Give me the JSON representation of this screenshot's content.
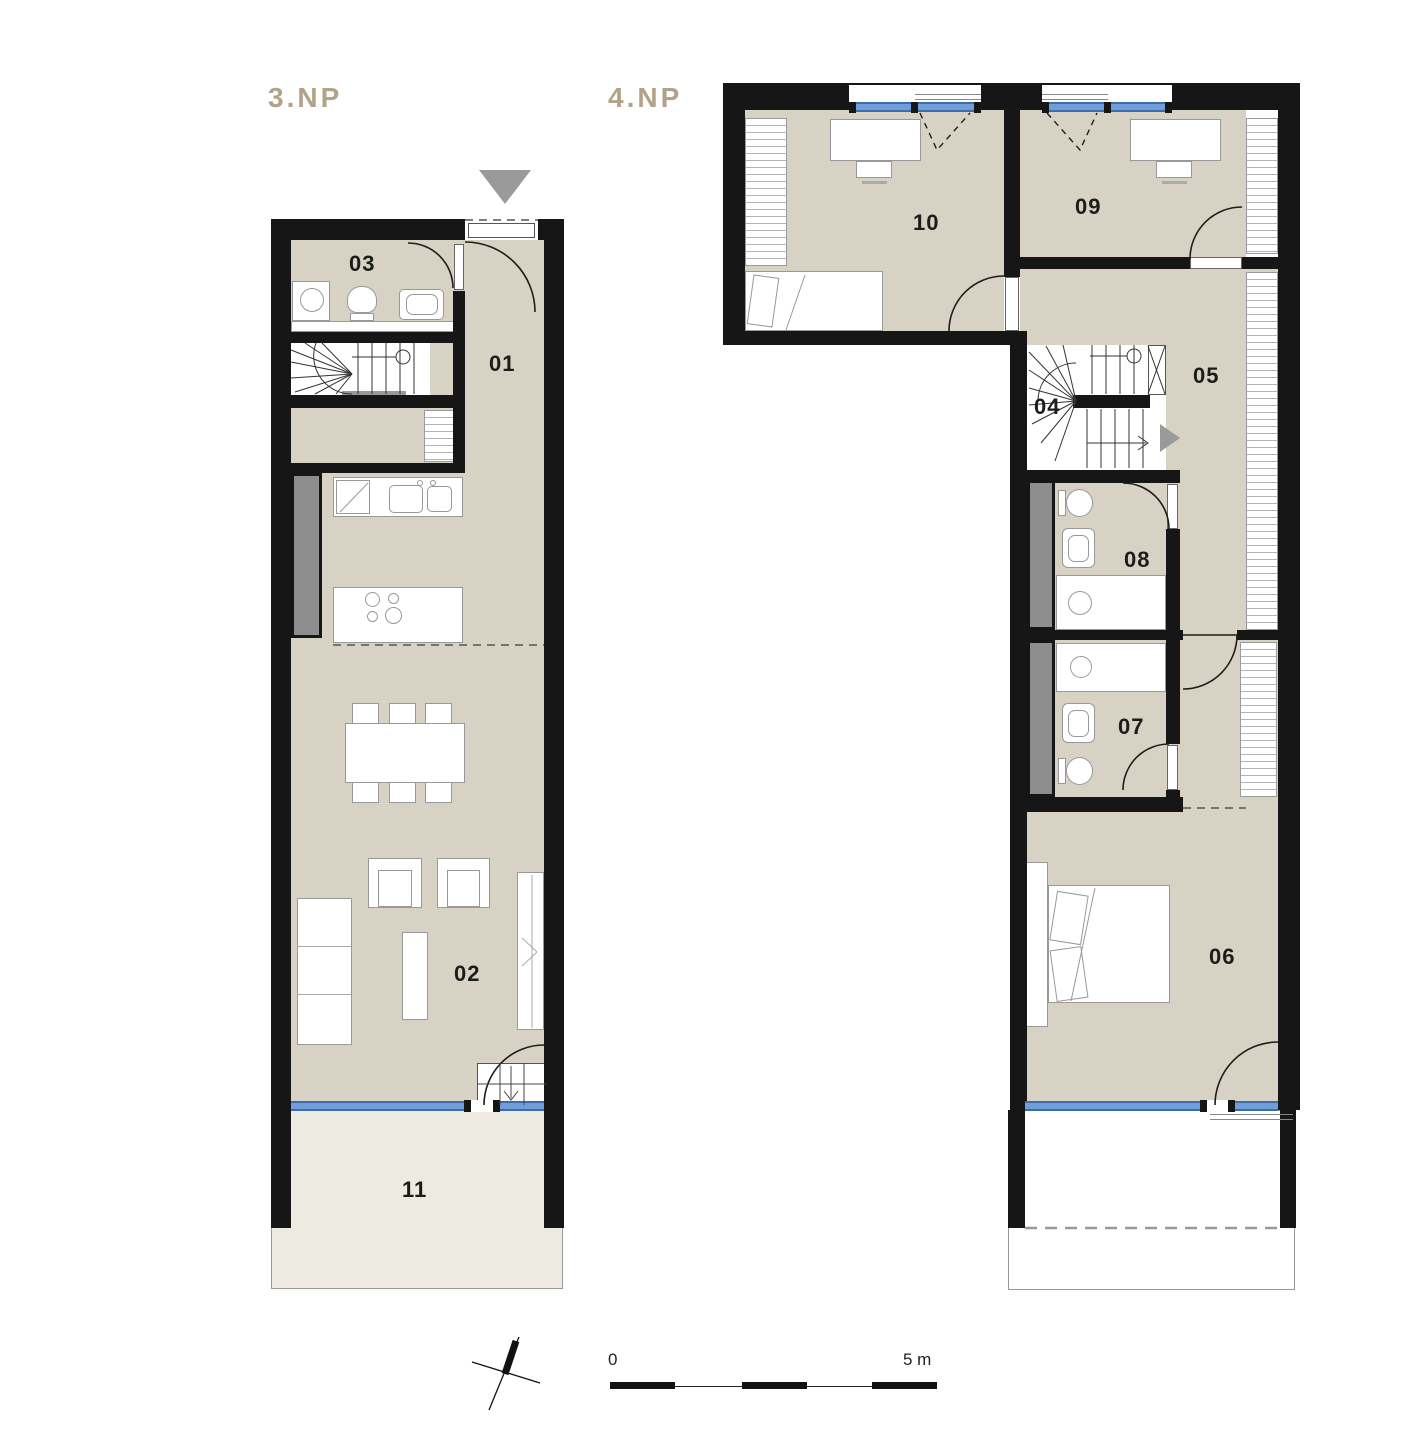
{
  "floor3": {
    "title": "3.NP",
    "rooms": {
      "r01": "01",
      "r02": "02",
      "r03": "03",
      "r11": "11"
    }
  },
  "floor4": {
    "title": "4.NP",
    "rooms": {
      "r04": "04",
      "r05": "05",
      "r06": "06",
      "r07": "07",
      "r08": "08",
      "r09": "09",
      "r10": "10"
    }
  },
  "scalebar": {
    "zero": "0",
    "five": "5 m"
  },
  "icons": {
    "entry_marker": "triangle-down",
    "walk_direction": "triangle-right",
    "north_indicator": "north-arrow"
  },
  "colors": {
    "wall": "#161616",
    "floor": "#d8d2c4",
    "terrace": "#edeae2",
    "accent": "#b3a289",
    "window": "#6f9ed9",
    "shaft": "#8e8e8e",
    "marker": "#9a9a9a"
  }
}
